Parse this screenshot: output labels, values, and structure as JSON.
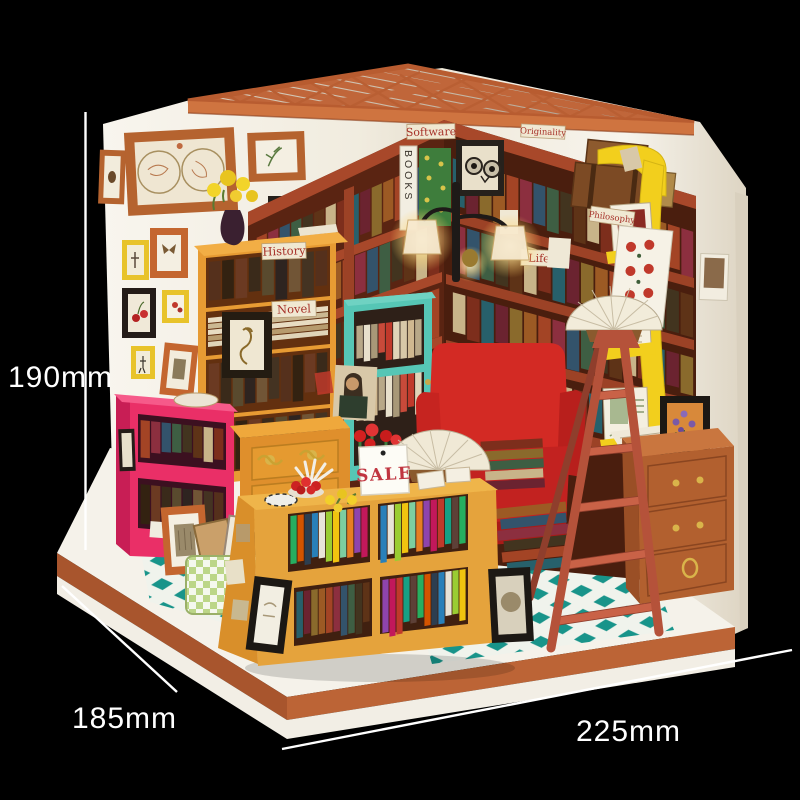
{
  "annotations": {
    "height": "190mm",
    "depth": "185mm",
    "width": "225mm"
  },
  "shelf_tags": {
    "history": "History",
    "novel": "Novel",
    "software": "Software",
    "originality": "Originality",
    "life": "Life",
    "philosophy": "Philosophy"
  },
  "signs": {
    "sale": "SALE",
    "book_spine": "BOOKS"
  },
  "colors": {
    "background": "#000000",
    "dimension_text": "#ffffff",
    "wall": "#f5f1e8",
    "roof_beam": "#c0663a",
    "roof_fascia": "#cf7440",
    "platform": "#f5f2ea",
    "base_trim_left": "#a8552d",
    "base_trim_right": "#bc6436",
    "floor_teal": "#18948a",
    "big_shelf": "#a8482a",
    "tall_shelf": "#e79b33",
    "pink_shelf": "#ea2f67",
    "teal_cabinet": "#56c6b5",
    "armchair": "#d32a24",
    "ladder": "#b5523a",
    "rack_yellow": "#f2cf1d",
    "drawer_cabinet": "#b2602f",
    "display_shelf": "#e5a33c",
    "banner_bg": "#f0e8d2",
    "banner_text": "#a63028",
    "sale_red": "#c03540"
  }
}
